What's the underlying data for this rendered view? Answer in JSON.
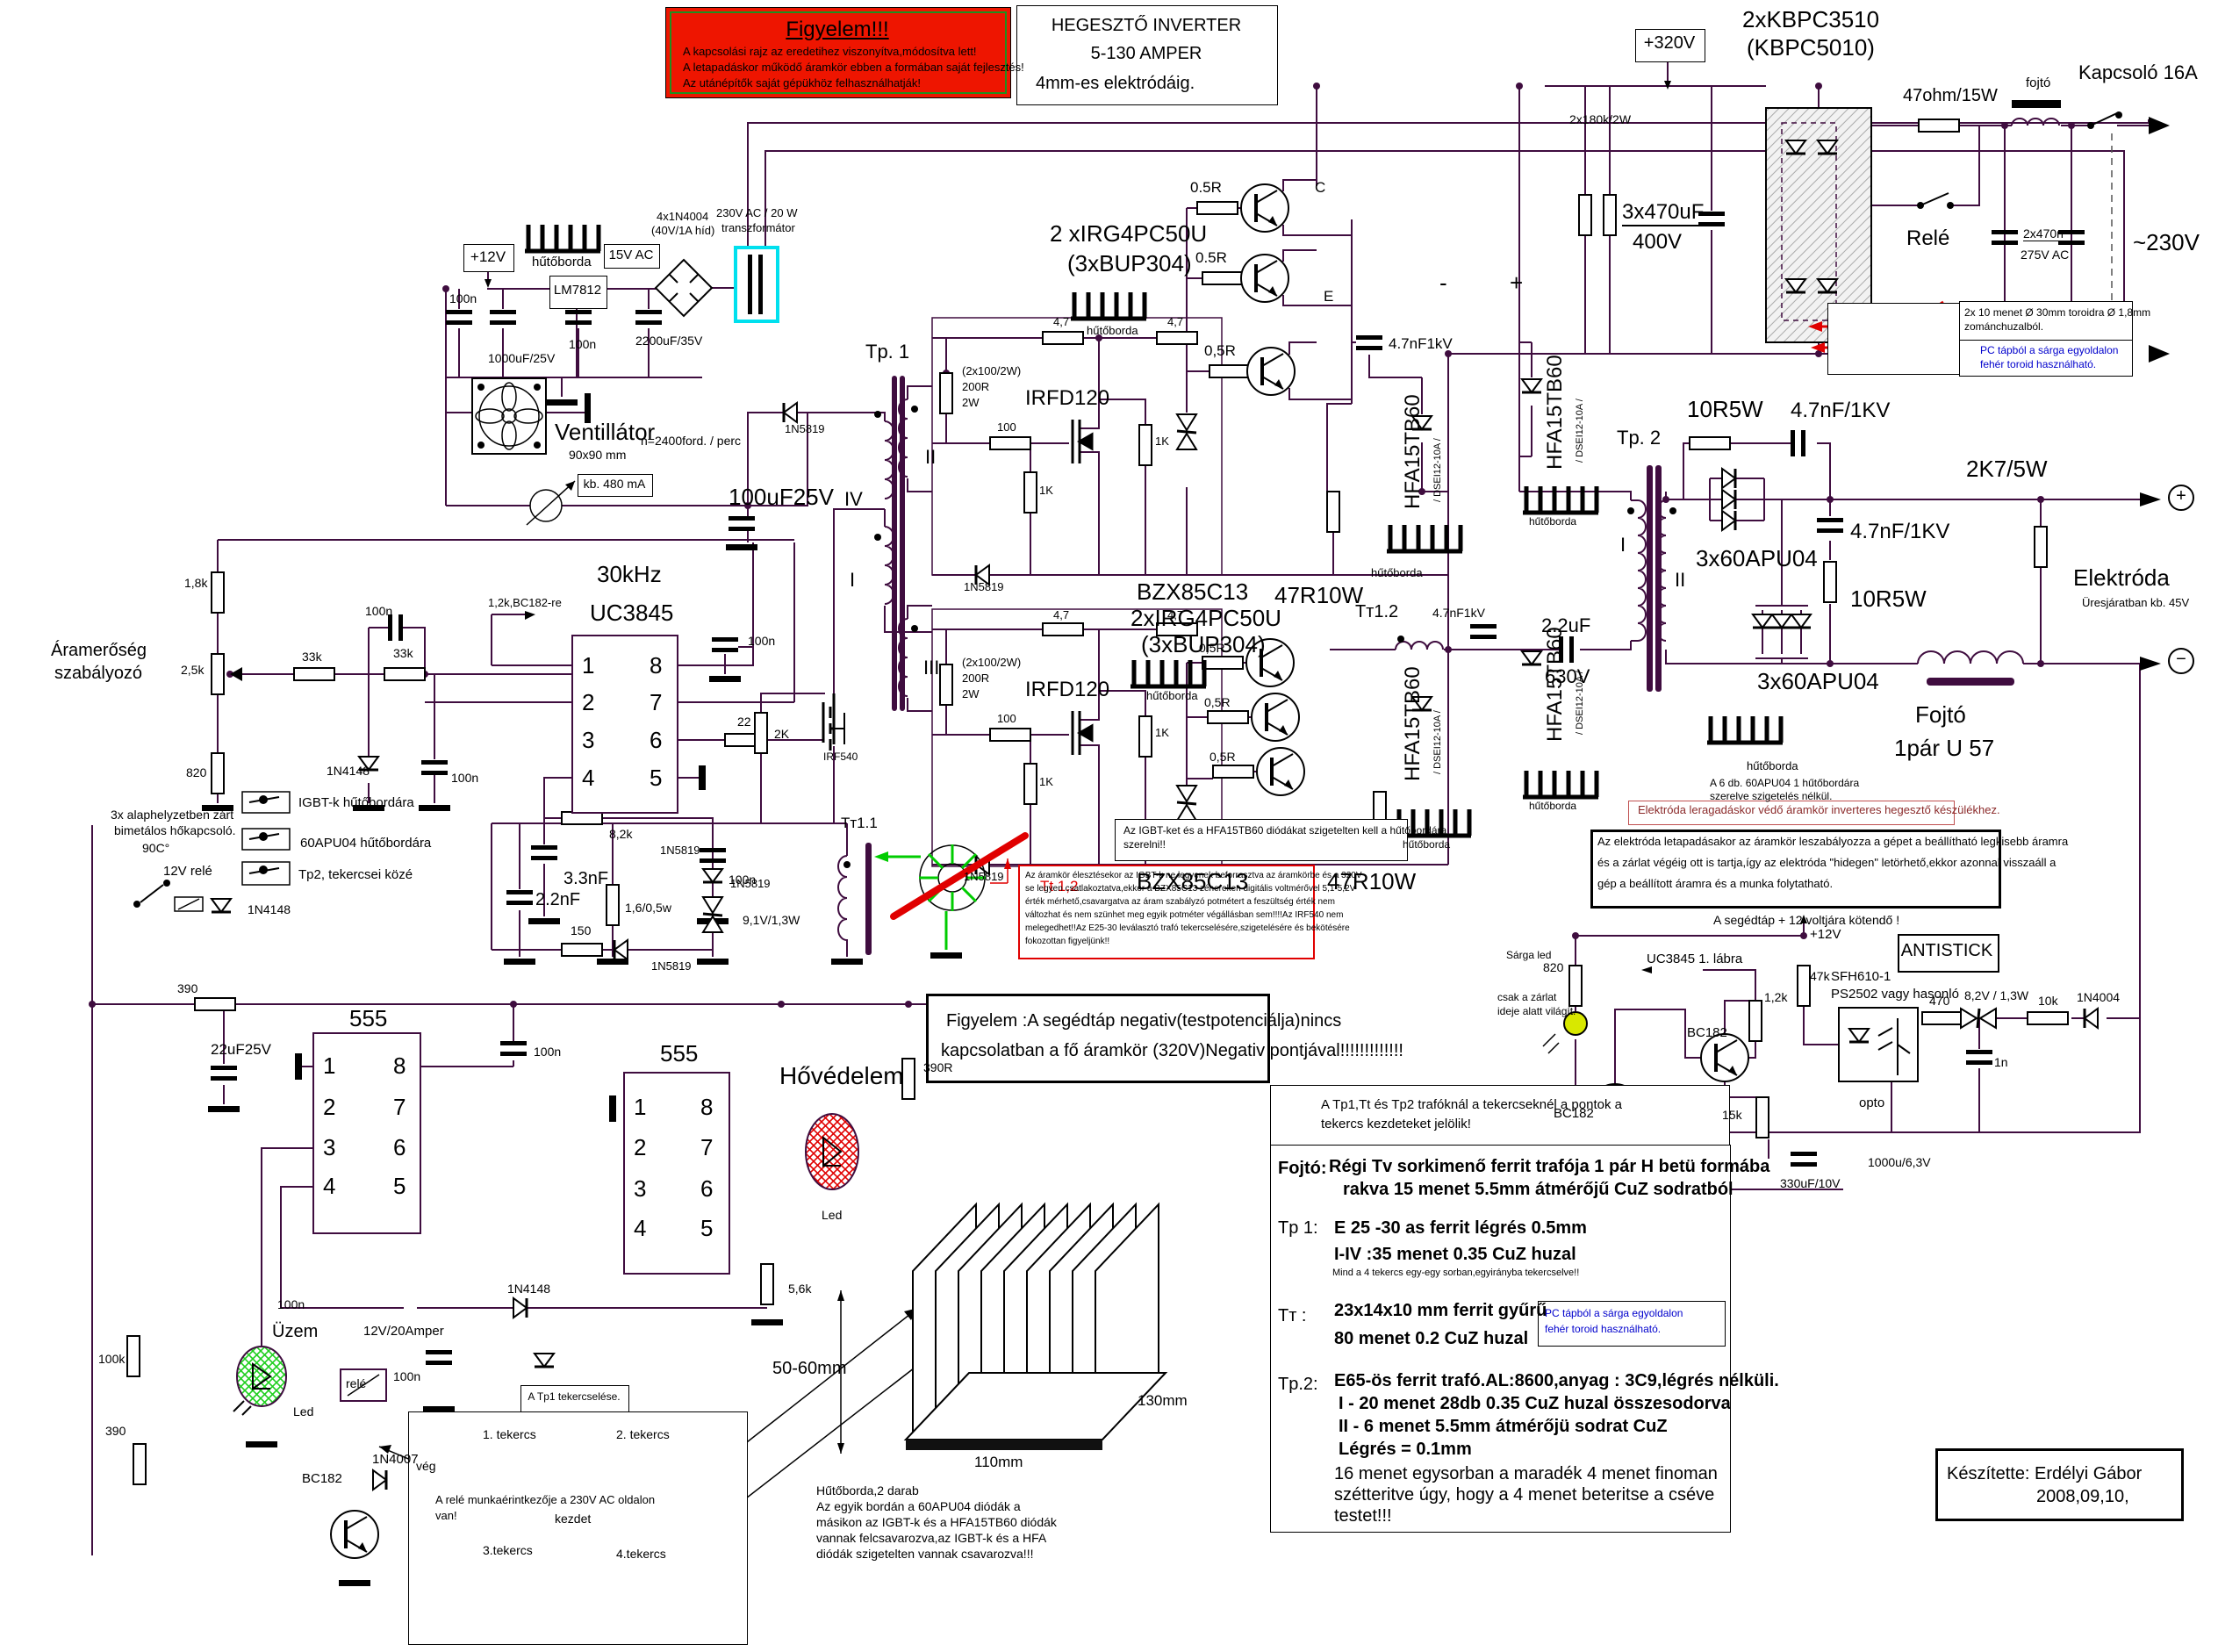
{
  "title_box": {
    "line1": "HEGESZTŐ INVERTER",
    "line2": "5-130 AMPER",
    "line3": "4mm-es elektródáig."
  },
  "warning_box": {
    "title": "Figyelem!!!",
    "line1": "A kapcsolási rajz az eredetihez viszonyítva,módosítva lett!",
    "line2": "A letapadáskor működő áramkör ebben a formában saját fejlesztés!",
    "line3": "Az utánépítők saját gépükhöz felhasználhatják!"
  },
  "mains": {
    "plus320": "+320V",
    "bridge1": "2xKBPC3510",
    "bridge2": "(KBPC5010)",
    "bleeder": "2x180k/2W",
    "bulk1": "3x470uF",
    "bulk2": "400V",
    "inrush": "47ohm/15W",
    "relay": "Relé",
    "choke": "fojtó",
    "cap1": "2x470n",
    "cap2": "275V AC",
    "switch": "Kapcsoló 16A",
    "ac": "~230V"
  },
  "toroid_note": {
    "line1": "2x 10 menet Ø 30mm toroidra  Ø  1,8mm",
    "line2": "zománchuzalból.",
    "blue1": "PC tápból a sárga egyoldalon",
    "blue2": "fehér toroid használható."
  },
  "aux": {
    "plus12": "+12V",
    "heatsink": "hűtőborda",
    "v15": "15V AC",
    "bridge1": "4x1N4004",
    "bridge2": "(40V/1A híd)",
    "trafo1": "230V  AC / 20 W",
    "trafo2": "transzformátor",
    "reg": "LM7812",
    "c1": "100n",
    "c2": "1000uF/25V",
    "c3": "100n",
    "c4": "2200uF/35V",
    "fan1": "Ventillátor",
    "fan2": "90x90 mm",
    "fan3": "n=2400ford. / perc",
    "current": "kb. 480 mA",
    "c5": "100uF25V",
    "d1": "1N5819"
  },
  "tp1": {
    "label": "Tp. 1",
    "w2": "II",
    "w4": "IV",
    "w1": "I",
    "w3": "III"
  },
  "pins": {
    "p1": "1",
    "p2": "2",
    "p3": "3",
    "p4": "4",
    "p5": "5",
    "p6": "6",
    "p7": "7",
    "p8": "8"
  },
  "control": {
    "freq": "30kHz",
    "ic": "UC3845",
    "note": "1,2k,BC182-re",
    "r1": "1,8k",
    "r2": "2,5k",
    "r3": "820",
    "r4": "33k",
    "r5": "33k",
    "c1": "100n",
    "d1": "1N4148",
    "c2": "100n",
    "r6": "8,2k",
    "c3": "3.3nF",
    "c4": "100n",
    "r7": "150",
    "d2": "1N5819",
    "r8": "22",
    "c5": "100n",
    "reg1": "Áramerőség",
    "reg2": "szabályozó",
    "mosfet": "IRF540",
    "r9": "2K",
    "c6": "2.2nF",
    "r10": "1,6/0,5w",
    "d3": "1N5819",
    "d4": "1N5819",
    "z1": "9,1V/1,3W",
    "tt": "Tт1.1"
  },
  "thermal": {
    "l1": "3x alaphelyzetben zárt",
    "l2": "bimetálos hőkapcsoló.",
    "l3": "90C°",
    "relay": "12V relé",
    "d1": "1N4148",
    "sw1": "IGBT-k hűtőbordára",
    "sw2": "60APU04 hűtőbordára",
    "sw3": "Tp2,  tekercsei közé"
  },
  "driver_top": {
    "note1": "(2x100/2W)",
    "note2": "200R",
    "note3": "2W",
    "fet": "IRFD120",
    "r1": "100",
    "r2": "1K",
    "r3": "1K",
    "d1": "1N5819",
    "r4": "4,7",
    "r5": "4,7",
    "zener": "BZX85C13",
    "r7": "47R10W",
    "hs": "hűtőborda"
  },
  "igbt_top": {
    "name1": "2 xIRG4PC50U",
    "name2": "(3xBUP304)",
    "hs": "hűtőborda",
    "r1": "0.5R",
    "r2": "0.5R",
    "r3": "0,5R",
    "c": "C",
    "e": "E",
    "cap": "4.7nF1kV",
    "minus": "-",
    "plus": "+"
  },
  "hfa": {
    "name": "HFA15TB60",
    "alt": "/ DSEI12-10A /",
    "hs": "hűtőborda"
  },
  "driver_bot": {
    "name1": "2xIRG4PC50U",
    "name2": "(3xBUP304)",
    "hs": "hűtőborda",
    "note1": "(2x100/2W)",
    "note2": "200R",
    "note3": "2W",
    "fet": "IRFD120",
    "r1": "100",
    "r2": "4,7",
    "r3": "4,7",
    "r4": "1K",
    "r5": "1K",
    "d1": "1N5819",
    "zener": "BZX85C13",
    "r6": "47R10W",
    "r7": "0,5R",
    "r8": "0,5R",
    "r9": "0,5R",
    "tt": "Tт1.2",
    "cap": "4.7nF1kV",
    "cap2_1": "2.2uF",
    "cap2_2": "630V"
  },
  "tp2": {
    "label": "Tp. 2",
    "w1": "I",
    "w2": "II"
  },
  "output": {
    "r1": "10R5W",
    "c1": "4.7nF/1KV",
    "d1": "3x60APU04",
    "c2": "4.7nF/1KV",
    "r2": "10R5W",
    "r3": "2K7/5W",
    "d2": "3x60APU04",
    "hs": "hűtőborda",
    "note1": "A 6 db. 60APU04 1 hűtőbordára",
    "note2": "szerelve szigetelés nélkül.",
    "choke1": "Fojtó",
    "choke2": "1pár U 57",
    "electrode": "Elektróda",
    "idle": "Üresjáratban kb. 45V",
    "plus": "+",
    "minus": "−"
  },
  "notes": {
    "igbt1": "Az IGBT-ket és a HFA15TB60 diódákat szigetelten kell a hűtőbordára",
    "igbt2": "szerelni!!",
    "tt12": "Tt 1,2",
    "red1": "Az áramkör élesztésekor az IGBT-k ne legyenek beforrasztva az áramkörbe és a 320V",
    "red2": "se legyen csatlakoztatva,ekkor a BZX85C13 zénereken digitális voltmérővel 5,1-5,2V",
    "red3": "érték mérhető,csavargatva az áram szabályzó potmétert a feszültség érték nem",
    "red4": "változhat és nem szünhet meg egyik potméter végállásban sem!!!!Az IRF540 nem",
    "red5": "melegedhet!!Az E25-30 leválasztó trafó tekercselésére,szigetelésére és bekötésére",
    "red6": "fokozottan figyeljünk!!",
    "fig1": "Figyelem :A segédtáp negativ(testpotenciálja)nincs",
    "fig2": "kapcsolatban a fő áramkör (320V)Negativ pontjával!!!!!!!!!!!!!"
  },
  "antistick": {
    "title": "Elektróda leragadáskor védő áramkör inverteres hegesztő készülékhez.",
    "box1": "Az elektróda letapadásakor az áramkör leszabályozza a gépet a beállítható legkisebb áramra",
    "box2": "és a zárlat végéig ott is tartja,így az elektróda  \"hidegen\"  letörhető,ekkor azonnal visszaáll a",
    "box3": "gép a beállított áramra és a munka folytatható.",
    "note": "A segédtáp + 12 voltjára kötendő !",
    "plus12": "+12V",
    "r820": "820",
    "uc": "UC3845  1. lábra",
    "r12k": "1,2k",
    "r47k": "47k",
    "q1": "BC182",
    "q2": "BC182",
    "opto1": "SFH610-1",
    "opto2": "PS2502 vagy hasonló",
    "opto3": "opto",
    "r470": "470",
    "z82": "8,2V / 1,3W",
    "r10k": "10k",
    "d1": "1N4004",
    "c1n": "1n",
    "r15k": "15k",
    "c330": "330uF/10V",
    "c1000": "1000u/6,3V",
    "label": "ANTISTICK",
    "led1": "Sárga led",
    "led2": "csak a zárlat",
    "led3": "ideje alatt világít."
  },
  "timer": {
    "n1": "555",
    "n2": "555",
    "r390a": "390",
    "c22uf": "22uF25V",
    "c100n1": "100n",
    "c100n2": "100n",
    "c100n3": "100n",
    "hot": "Hővédelem",
    "r390r": "390R",
    "led_r": "Led",
    "r56k": "5,6k",
    "d1": "1N4148",
    "uzem": "Üzem",
    "led_g": "Led",
    "v12": "12V/20Amper",
    "rele": "relé",
    "d2": "1N4007",
    "q": "BC182",
    "r100k": "100k",
    "r390b": "390",
    "relay_note1": "A relé munkaérintkezője a 230V AC oldalon",
    "relay_note2": "van!"
  },
  "heatsink_draw": {
    "dim1": "50-60mm",
    "dim2": "130mm",
    "dim3": "110mm",
    "t1": "Hűtőborda,2 darab",
    "t2": "Az egyik bordán a 60APU04 diódák a",
    "t3": "másikon az IGBT-k és a HFA15TB60 diódák",
    "t4": "vannak felcsavarozva,az IGBT-k és a HFA",
    "t5": "diódák szigetelten vannak csavarozva!!!"
  },
  "tp1_winding": {
    "title": "A Tp1 tekercselése.",
    "w1": "1. tekercs",
    "w2": "2. tekercs",
    "w3": "3.tekercs",
    "w4": "4.tekercs",
    "start": "kezdet",
    "end": "vég"
  },
  "specs": {
    "hdr1": "A Tp1,Tt és Tp2 trafóknál a tekercseknél a pontok a",
    "hdr2": "tekercs kezdeteket  jelölik!",
    "fojto_l": "Fojtó:",
    "fojto1": "Régi Tv sorkimenő ferrit trafója 1 pár H betü formába",
    "fojto2": "rakva   15 menet  5.5mm átmérőjű CuZ sodratból",
    "tp1_l": "Tp 1:",
    "tp1a": "E 25 -30 as ferrit   légrés 0.5mm",
    "tp1b": "I-IV :35 menet 0.35 CuZ huzal",
    "tp1c": "Mind a 4 tekercs egy-egy sorban,egyirányba tekercselve!!",
    "tt_l": "Tт :",
    "tta": "23x14x10 mm  ferrit gyűrű",
    "ttb": "80 menet 0.2 CuZ huzal",
    "blue1": "PC tápból a sárga egyoldalon",
    "blue2": "fehér toroid használható.",
    "tp2_l": "Tp.2:",
    "tp2a": "E65-ös ferrit trafó.AL:8600,anyag : 3C9,légrés nélküli.",
    "tp2b": "I - 20 menet    28db   0.35  CuZ huzal összesodorva",
    "tp2c": "II - 6 menet     5.5mm átmérőjü  sodrat  CuZ",
    "tp2d": "Légrés = 0.1mm",
    "tp2e": "16 menet egysorban a maradék 4 menet finoman",
    "tp2f": "szétteritve úgy, hogy a  4  menet beteritse a cséve",
    "tp2g": "testet!!!"
  },
  "credit": {
    "line1": "Készítette: Erdélyi Gábor",
    "line2": "2008,09,10,"
  }
}
